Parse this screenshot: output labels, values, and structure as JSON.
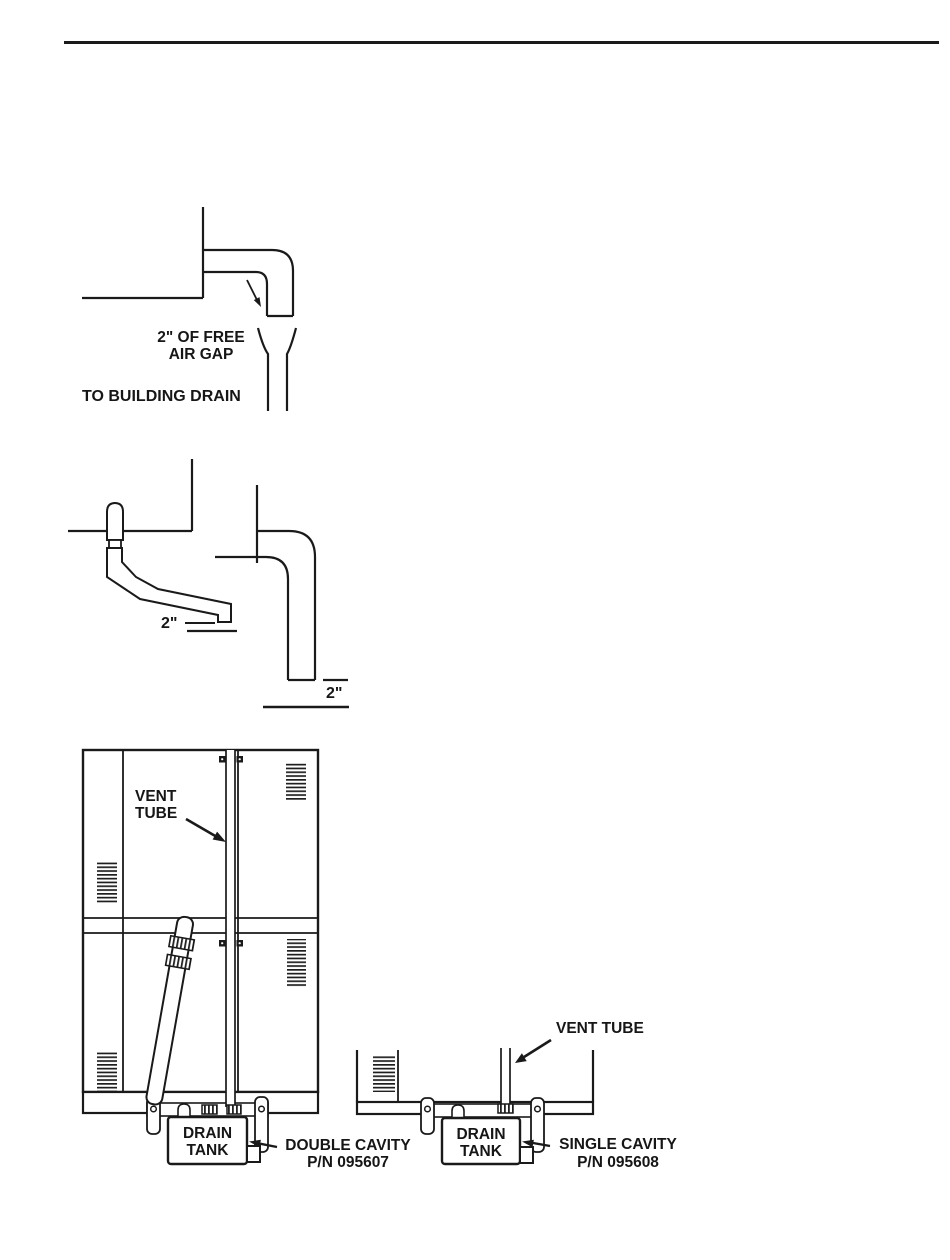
{
  "page": {
    "ink_color": "#1a1a1a",
    "background_color": "#ffffff"
  },
  "figures": {
    "air_gap": {
      "gap_label_line1": "2\" OF FREE",
      "gap_label_line2": "AIR GAP",
      "drain_label": "TO BUILDING DRAIN"
    },
    "standpipe_gap": {
      "left_gap_label": "2\"",
      "right_gap_label": "2\""
    },
    "double_cavity": {
      "vent_label_line1": "VENT",
      "vent_label_line2": "TUBE",
      "tank_label_line1": "DRAIN",
      "tank_label_line2": "TANK",
      "caption_line1": "DOUBLE CAVITY",
      "caption_line2": "P/N 095607"
    },
    "single_cavity": {
      "vent_label": "VENT TUBE",
      "tank_label_line1": "DRAIN",
      "tank_label_line2": "TANK",
      "caption_line1": "SINGLE CAVITY",
      "caption_line2": "P/N 095608"
    }
  }
}
